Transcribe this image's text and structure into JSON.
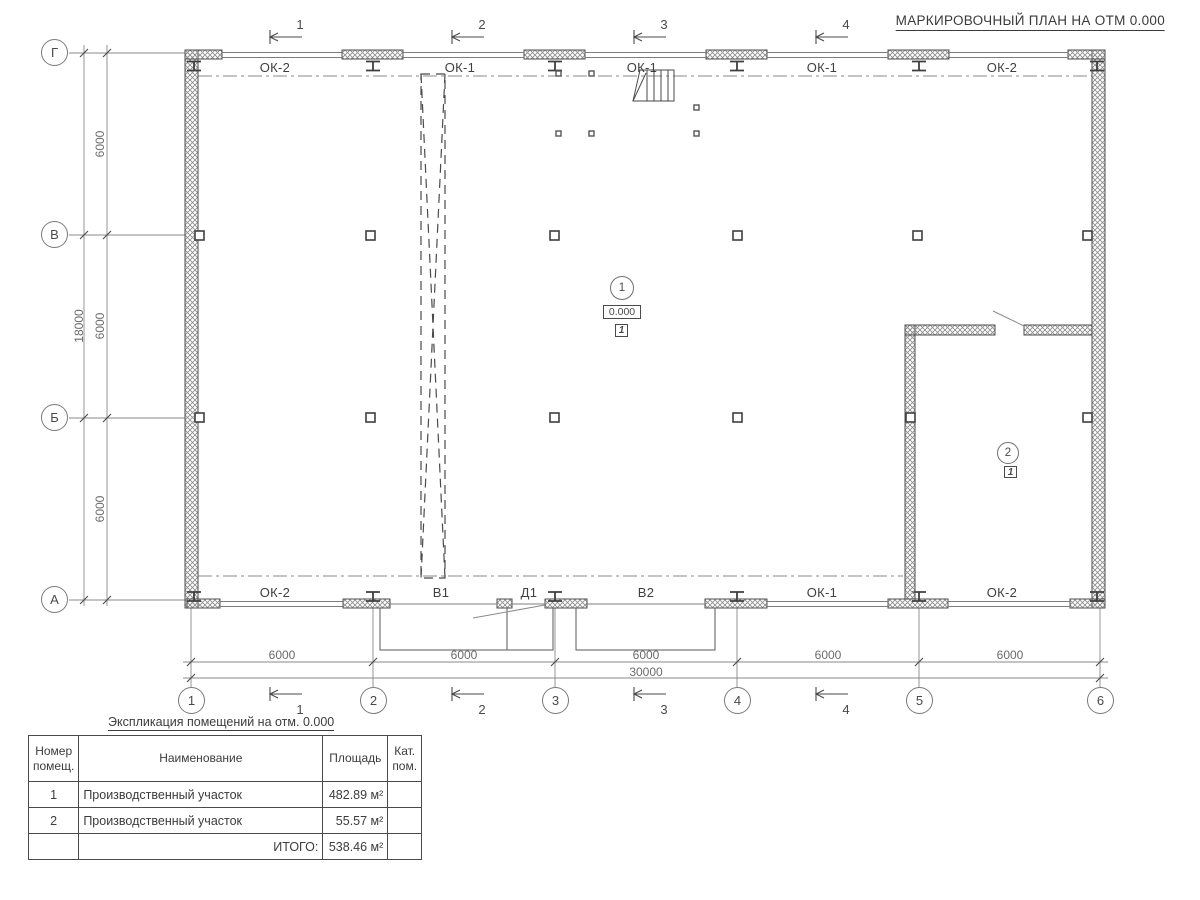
{
  "title": "МАРКИРОВОЧНЫЙ ПЛАН НА ОТМ 0.000",
  "axes": {
    "rows": [
      "Г",
      "В",
      "Б",
      "А"
    ],
    "cols": [
      "1",
      "2",
      "3",
      "4",
      "5",
      "6"
    ]
  },
  "sections": [
    "1",
    "2",
    "3",
    "4"
  ],
  "windows_top": [
    "ОК-2",
    "ОК-1",
    "ОК-1",
    "ОК-1",
    "ОК-2"
  ],
  "openings_bottom": [
    "ОК-2",
    "В1",
    "Д1",
    "В2",
    "ОК-1",
    "ОК-2"
  ],
  "dimensions": {
    "left_bays": [
      "6000",
      "6000",
      "6000"
    ],
    "left_total": "18000",
    "bottom_bays": [
      "6000",
      "6000",
      "6000",
      "6000",
      "6000"
    ],
    "bottom_total": "30000"
  },
  "rooms": [
    {
      "number": "1",
      "elevation": "0.000",
      "category": "1"
    },
    {
      "number": "2",
      "category": "1"
    }
  ],
  "table": {
    "title": "Экспликация помещений на отм. 0.000",
    "headers": [
      "Номер\nпомещ.",
      "Наименование",
      "Площадь",
      "Кат.\nпом."
    ],
    "rows": [
      {
        "num": "1",
        "name": "Производственный участок",
        "area": "482.89 м²",
        "cat": ""
      },
      {
        "num": "2",
        "name": "Производственный участок",
        "area": "55.57 м²",
        "cat": ""
      }
    ],
    "total_label": "ИТОГО:",
    "total_value": "538.46 м²"
  },
  "colors": {
    "line_dark": "#4a4a4a",
    "line_light": "#8a8a8a",
    "hatch": "#8f8f8f"
  }
}
